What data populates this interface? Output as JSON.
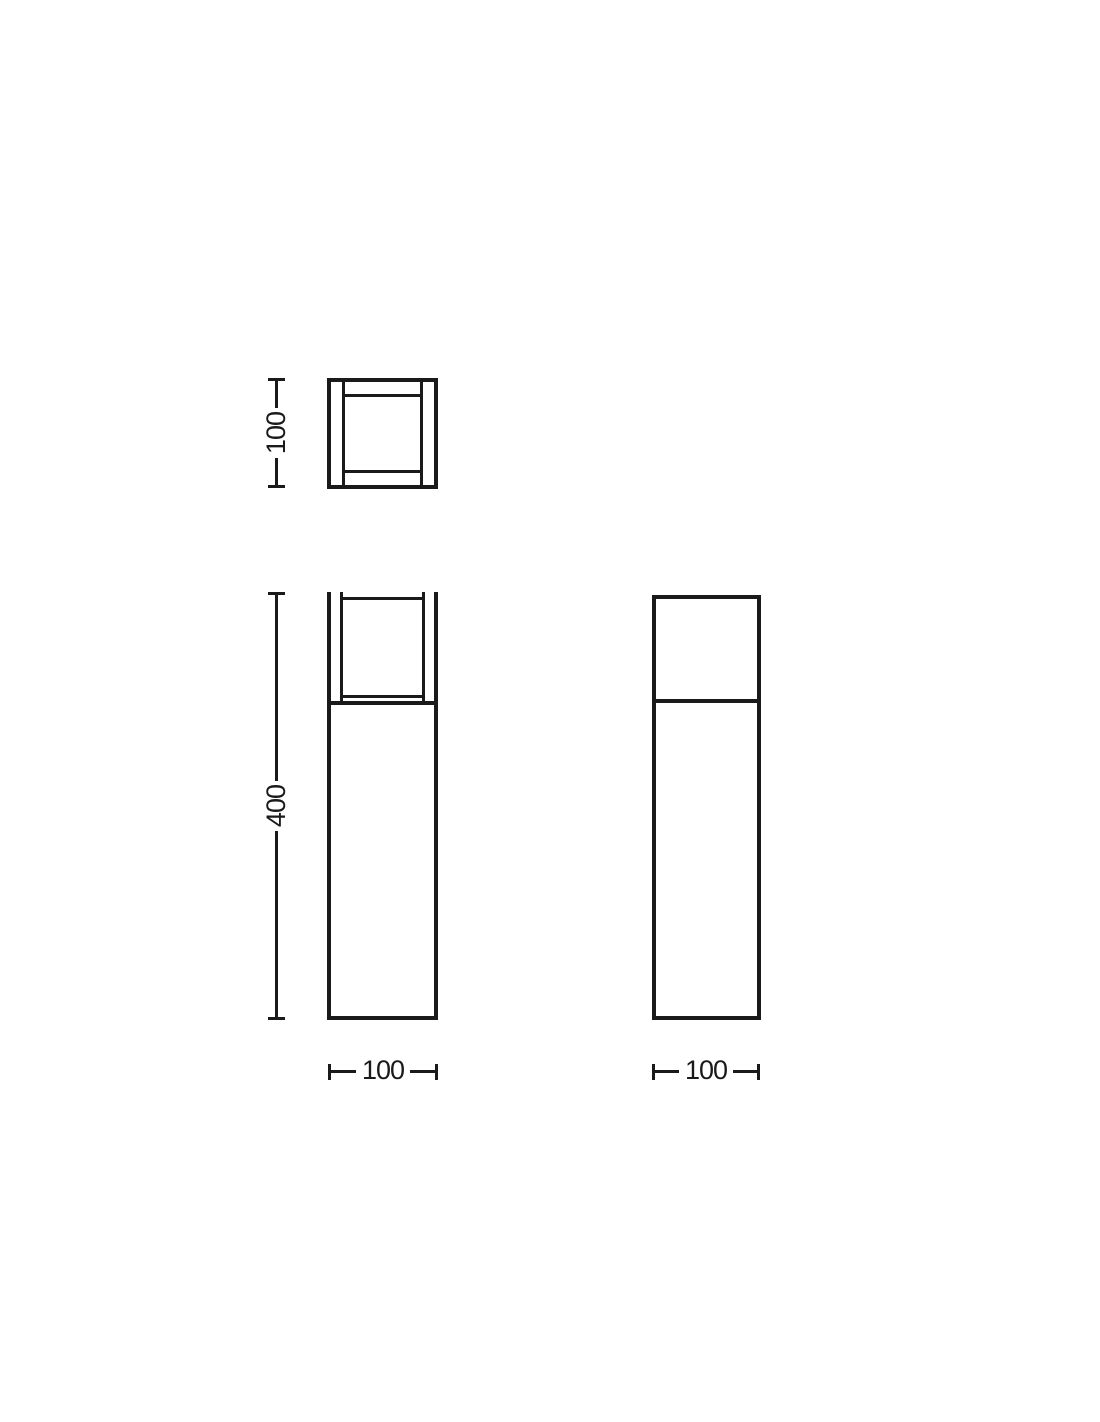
{
  "drawing": {
    "kind": "technical-dimension-drawing",
    "background_color": "#ffffff",
    "line_color": "#1a1a1a",
    "views": {
      "top_view": {
        "height_dim_label": "100"
      },
      "front_view": {
        "height_dim_label": "400",
        "width_dim_label": "100"
      },
      "side_view": {
        "width_dim_label": "100"
      }
    }
  }
}
